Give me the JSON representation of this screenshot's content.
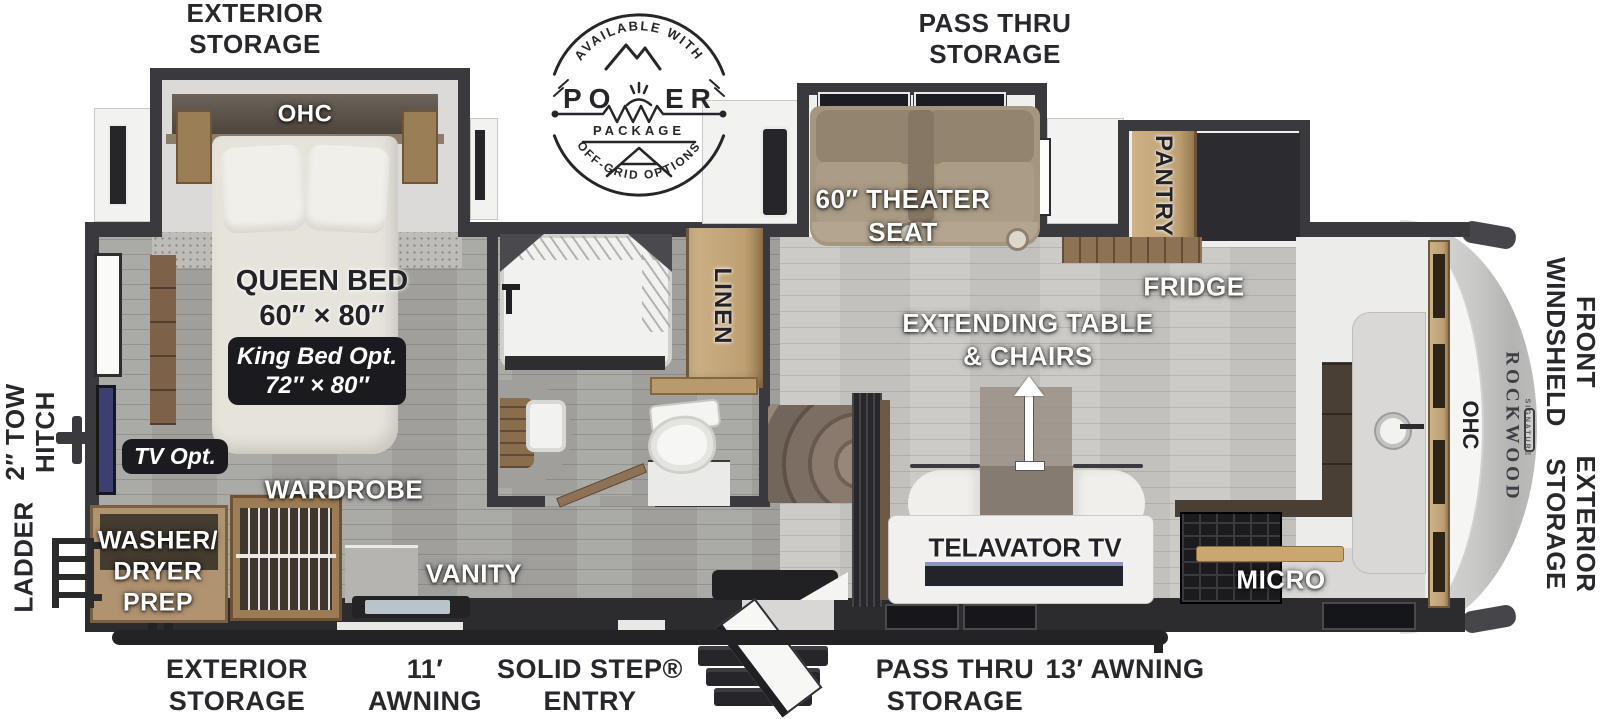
{
  "badge": {
    "arc_top": "AVAILABLE WITH",
    "power_left": "PO",
    "power_right": "ER",
    "package": "PACKAGE",
    "arc_bottom": "OFF-GRID OPTIONS"
  },
  "exterior": {
    "storage_top": {
      "l1": "EXTERIOR",
      "l2": "STORAGE"
    },
    "pass_thru_top": {
      "l1": "PASS THRU",
      "l2": "STORAGE"
    },
    "tow_hitch": {
      "l1": "2″ TOW",
      "l2": "HITCH"
    },
    "ladder": "LADDER",
    "front_windshield": {
      "l1": "FRONT",
      "l2": "WINDSHIELD"
    },
    "storage_right": {
      "l1": "EXTERIOR",
      "l2": "STORAGE"
    },
    "storage_bottom": {
      "l1": "EXTERIOR",
      "l2": "STORAGE"
    },
    "awning_11": {
      "l1": "11′",
      "l2": "AWNING"
    },
    "solid_step": {
      "l1": "SOLID STEP®",
      "l2": "ENTRY"
    },
    "pass_thru_bottom": {
      "l1": "PASS THRU",
      "l2": "STORAGE"
    },
    "awning_13": "13′ AWNING"
  },
  "bedroom": {
    "ohc": "OHC",
    "queen": {
      "l1": "QUEEN BED",
      "l2": "60″ × 80″"
    },
    "king_opt": {
      "l1": "King Bed Opt.",
      "l2": "72″ × 80″"
    },
    "tv_opt": "TV Opt.",
    "wardrobe": "WARDROBE",
    "washer": {
      "l1": "WASHER/",
      "l2": "DRYER",
      "l3": "PREP"
    }
  },
  "bath": {
    "linen": "LINEN",
    "vanity": "VANITY"
  },
  "living": {
    "theater": {
      "l1": "60″ THEATER",
      "l2": "SEAT"
    },
    "pantry": "PANTRY",
    "fridge": "FRIDGE",
    "table": {
      "l1": "EXTENDING TABLE",
      "l2": "& CHAIRS"
    },
    "telavator": "TELAVATOR TV",
    "micro": "MICRO",
    "ohc_front": "OHC"
  },
  "brand": {
    "name": "ROCKWOOD",
    "series": "SIGNATURE"
  },
  "colors": {
    "wall": "#3a3a3e",
    "label": "#28282c",
    "floor_rear": "#a6a5a2",
    "floor_living": "#c8c7c3",
    "wood": "#c2a77c",
    "theater_seat": "#a5967f",
    "fridge": "#2c2c30",
    "tv_screen": "#3c3f70"
  }
}
